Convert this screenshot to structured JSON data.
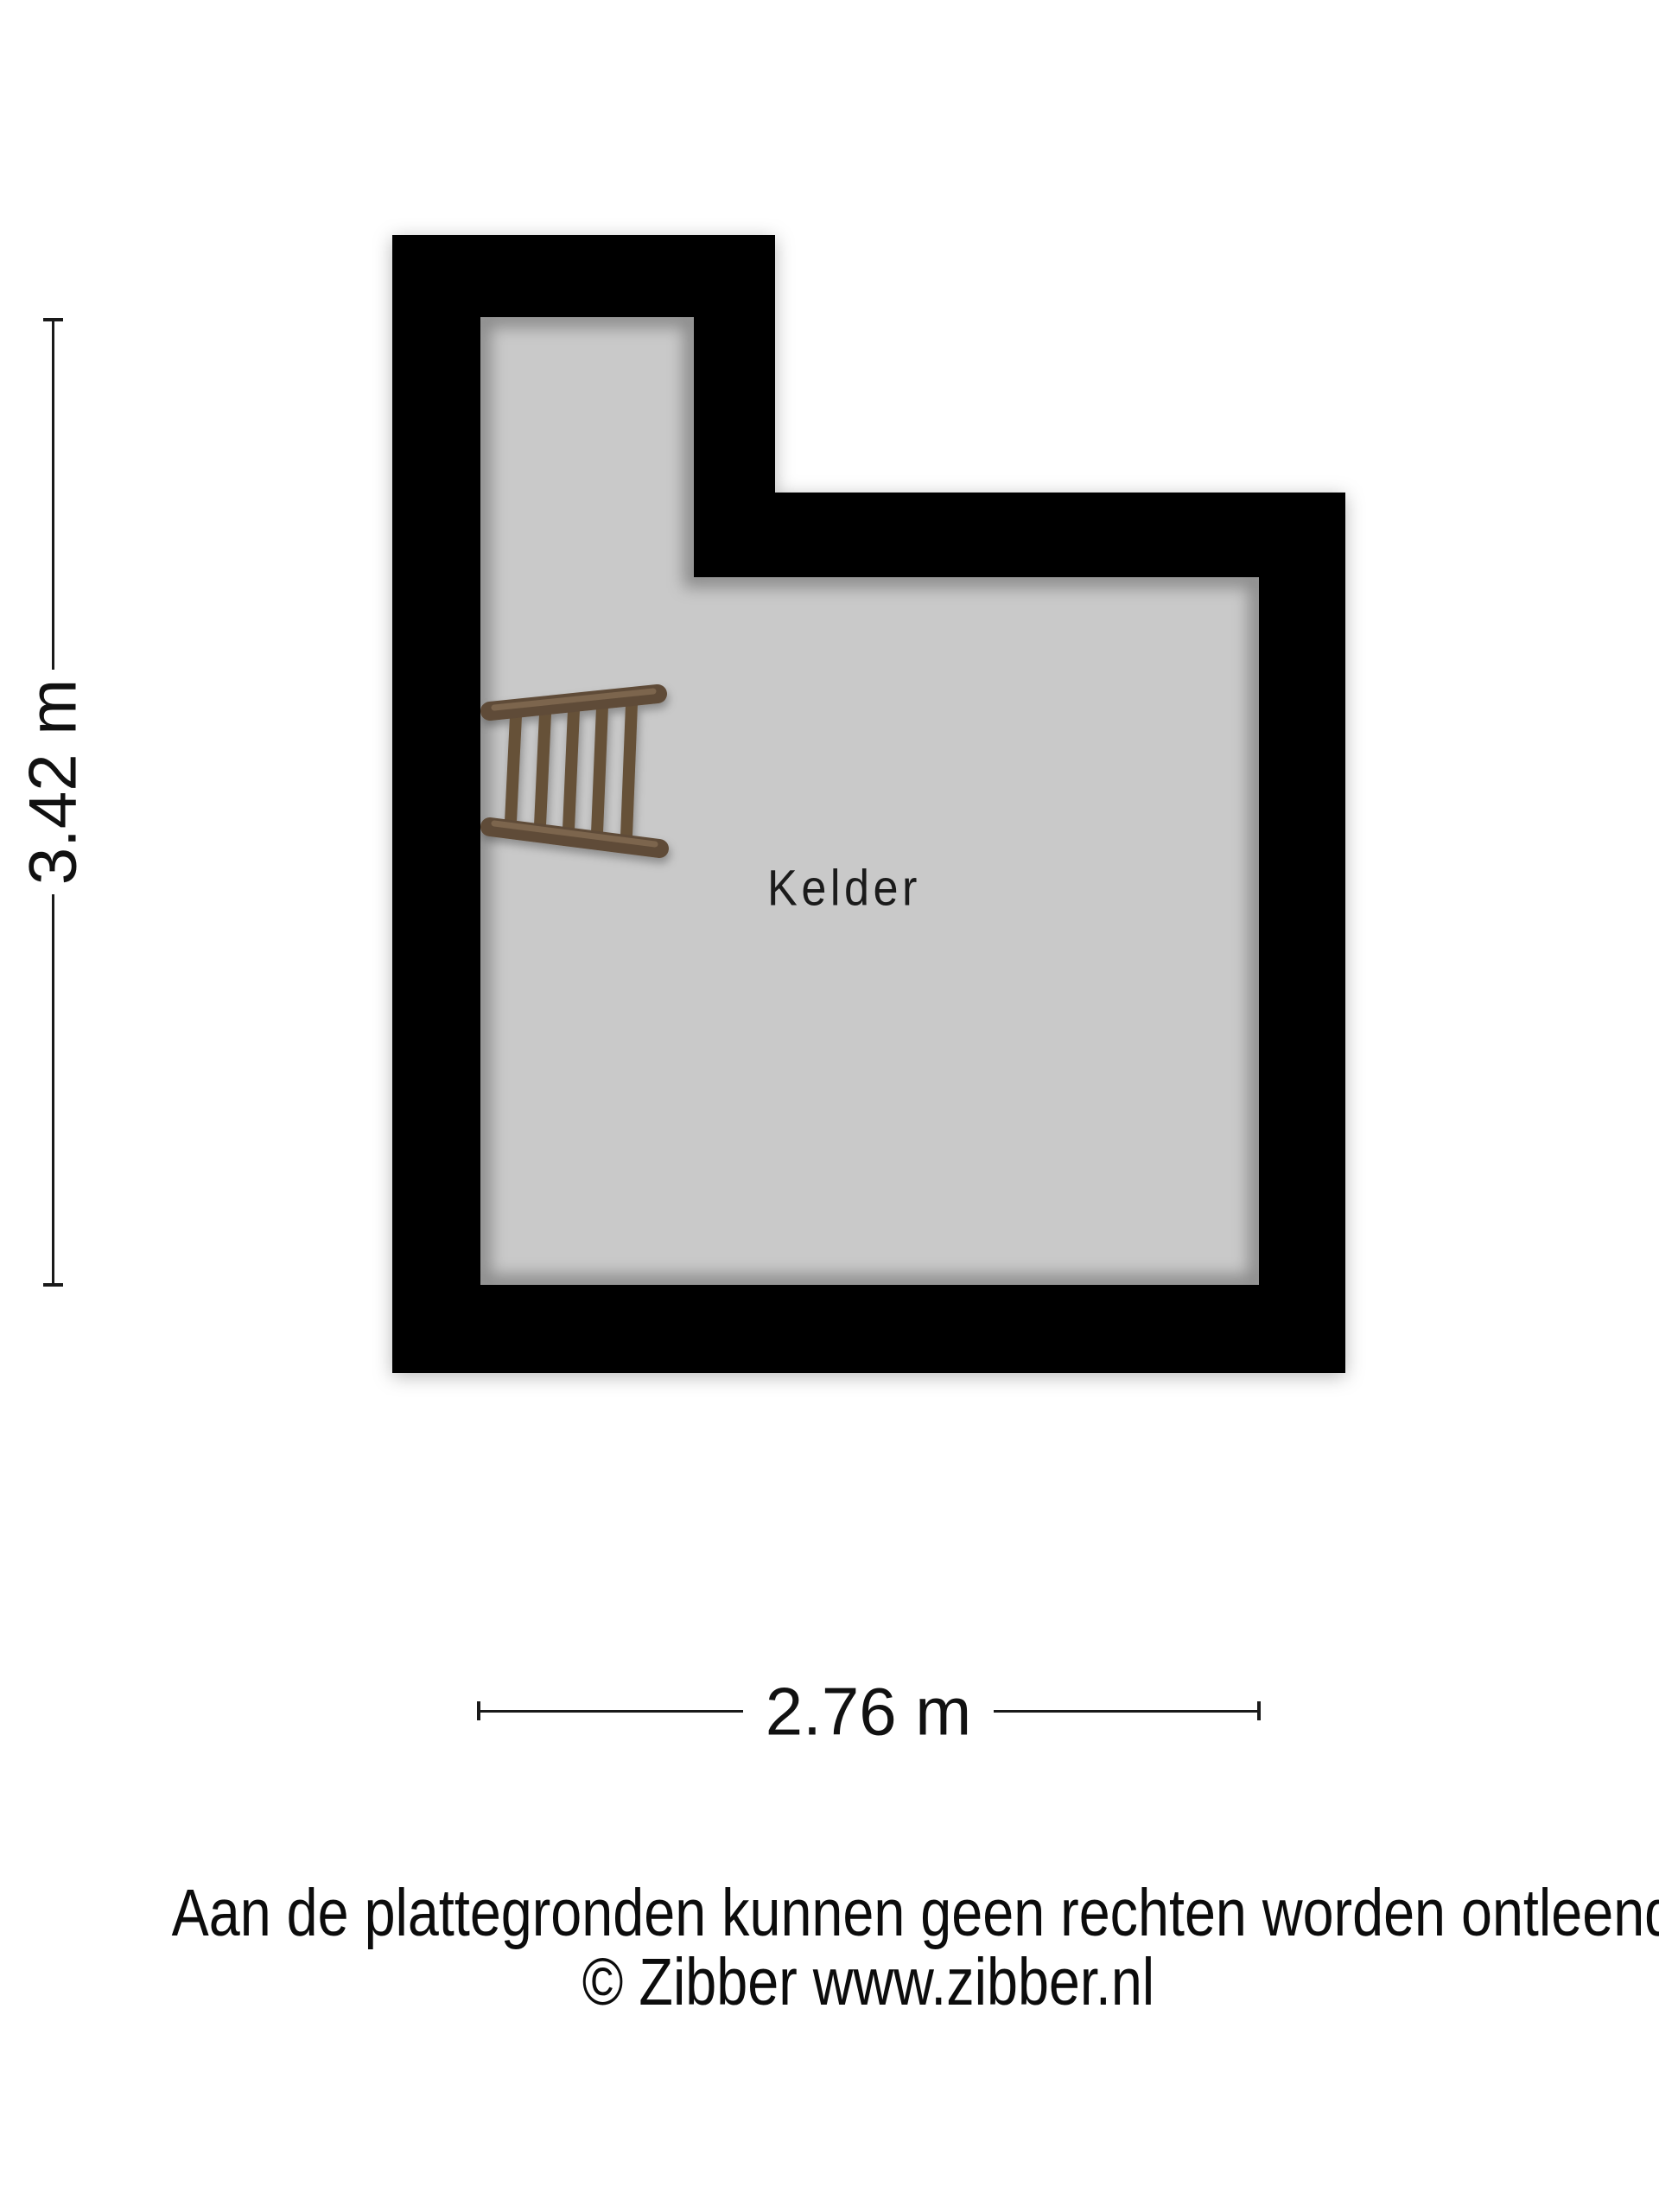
{
  "page": {
    "background_color": "#ffffff"
  },
  "floorplan": {
    "room_label": "Kelder",
    "wall_color": "#000000",
    "floor_color": "#c9c9c9",
    "ladder": {
      "rail_color": "#5f4b37",
      "rail_highlight_color": "#806a52",
      "rung_color": "#665139"
    }
  },
  "dimensions": {
    "vertical_label": "3.42 m",
    "vertical_value_m": 3.42,
    "horizontal_label": "2.76 m",
    "horizontal_value_m": 2.76,
    "line_color": "#1a1a1a"
  },
  "disclaimer": {
    "line1": "Aan de plattegronden kunnen geen rechten worden ontleend",
    "line2": "© Zibber www.zibber.nl"
  }
}
